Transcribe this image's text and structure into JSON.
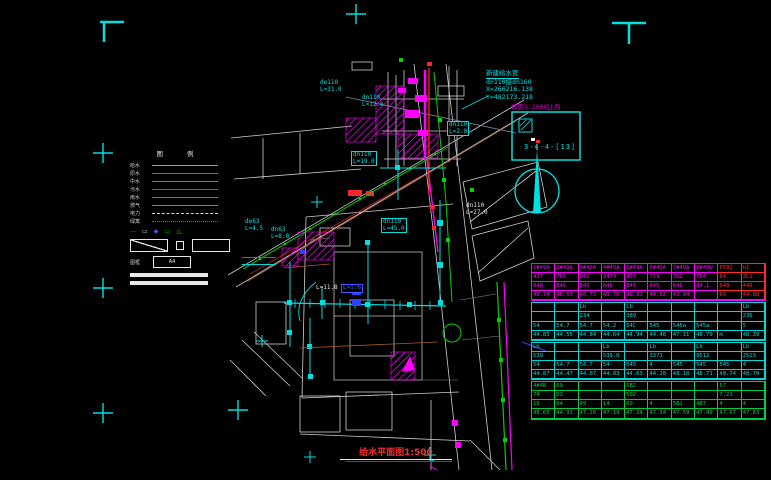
{
  "title": {
    "text": "给水平面图1:500"
  },
  "annotation": {
    "line1": "新建给水管",
    "line2": "dn110接dn160",
    "line3": "X=266216.138",
    "line4": "Y=482173.218"
  },
  "detail_box": {
    "caption": "详图1:2000比例",
    "code": "3-4-4-[13]"
  },
  "colors": {
    "cyan": "#00e0e0",
    "magenta": "#ff00ff",
    "red": "#ff2626",
    "green": "#00d400",
    "blue": "#3040ff",
    "white": "#d8d8d8",
    "table_magenta": "#ff00ff",
    "table_red": "#ff2a2a",
    "table_cyan": "#00d8d8",
    "table_green": "#00cc44"
  },
  "legend": {
    "title": "图 例",
    "rows": [
      {
        "label": "给水",
        "color": "#00dcdc",
        "style": "solid"
      },
      {
        "label": "原水",
        "color": "#ff3434",
        "style": "solid"
      },
      {
        "label": "中水",
        "color": "#00cc00",
        "style": "solid"
      },
      {
        "label": "污水",
        "color": "#a8522a",
        "style": "solid"
      },
      {
        "label": "雨水",
        "color": "#b46432",
        "style": "solid"
      },
      {
        "label": "燃气",
        "color": "#a87838",
        "style": "solid"
      },
      {
        "label": "电力",
        "color": "#d8d8d8",
        "style": "dashed"
      },
      {
        "label": "绿篱",
        "color": "#00bb00",
        "style": "dotted"
      }
    ],
    "symbol_row": [
      {
        "glyph": "—",
        "color": "#4455ff"
      },
      {
        "glyph": "▭",
        "color": "#e8e8e8"
      },
      {
        "glyph": "◆",
        "color": "#4455ff"
      },
      {
        "glyph": "▭",
        "color": "#00bb00"
      },
      {
        "glyph": "么",
        "color": "#00bb00"
      }
    ],
    "paper_label": "图框",
    "paper_box": "A4"
  },
  "labels": [
    {
      "text": "de110\nL=31.0",
      "color": "#00e0e0"
    },
    {
      "text": "dn110\nL=2.0",
      "color": "#00e0e0"
    },
    {
      "text": "dn110\nL=19.0",
      "color": "#00e0e0"
    },
    {
      "text": "dn110\nL=45.0",
      "color": "#00e0e0"
    },
    {
      "text": "dn110\nL=27.0",
      "color": "#e8e8e8"
    },
    {
      "text": "de63\nL=4.5",
      "color": "#00e0e0"
    },
    {
      "text": "dn63\nL=8.0",
      "color": "#00e0e0"
    },
    {
      "text": "L=11.8",
      "color": "#e8e8e8"
    },
    {
      "text": "L=5.6",
      "color": "#4455ff"
    },
    {
      "text": "dn110\nL=12.6",
      "color": "#00e0e0"
    }
  ],
  "table": {
    "sections": [
      {
        "color": "#ff00ff",
        "alt_color": "#ff2a2a",
        "alt_cols": [
          8,
          9
        ],
        "rows": [
          [
            "1#49A",
            "2#49A",
            "3#49A",
            "4#49A",
            "5#49A",
            "6#49A",
            "7#49A",
            "8#49W",
            "P592",
            "b1"
          ],
          [
            "437",
            "765",
            "842",
            "3479",
            "497",
            "759",
            "762",
            "764",
            "84",
            "3L1"
          ],
          [
            "848",
            "846",
            "845",
            "846",
            "848",
            "845",
            "846",
            "84.1",
            "648",
            "449"
          ],
          [
            "48.74",
            "48.63",
            "48.73",
            "48.76",
            "48.81",
            "44.82",
            "43.84",
            "",
            "69",
            "44.88"
          ]
        ]
      },
      {
        "color": "#00d8d8",
        "rows": [
          [
            "",
            "",
            "Lb",
            "",
            "Lb",
            "",
            "",
            "",
            "",
            "Lb"
          ],
          [
            "",
            "",
            "234",
            "",
            "389",
            "",
            "",
            "",
            "",
            "236"
          ],
          [
            "54",
            "54.7",
            "54.7",
            "54.2",
            "54C",
            "545",
            "545a",
            "545a",
            "",
            "5"
          ],
          [
            "44.85",
            "44.55",
            "44.84",
            "44.64",
            "44.94",
            "44.48",
            "47.11",
            "48.79",
            "m",
            "48.39"
          ]
        ]
      },
      {
        "color": "#00d8d8",
        "rows": [
          [
            "Lb",
            "",
            "",
            "Lb",
            "",
            "Lb",
            "",
            "Lb",
            "",
            "Lb"
          ],
          [
            "539",
            "",
            "",
            "539.0",
            "",
            "3371",
            "",
            "8512",
            "",
            "2513"
          ],
          [
            "54",
            "54.7",
            "54.7",
            "54",
            "545",
            "4",
            "545",
            "545",
            "545",
            "4"
          ],
          [
            "44.87",
            "44.47",
            "44.07",
            "44.83",
            "44.63",
            "44.10",
            "48.10",
            "48.71",
            "48.74",
            "48.79"
          ]
        ]
      },
      {
        "color": "#00cc44",
        "rows": [
          [
            "4#4B",
            "69",
            "",
            "",
            "5B2",
            "",
            "",
            "",
            "57",
            ""
          ],
          [
            "74",
            "D3",
            "",
            "",
            "502",
            "",
            "",
            "",
            "7.21",
            ""
          ],
          [
            "19",
            "94",
            "49",
            "14",
            "69",
            "4",
            "5B1",
            "4B7",
            "4",
            "4"
          ],
          [
            "48.65",
            "44.91",
            "47.26",
            "47.19",
            "47.24",
            "47.34",
            "47.59",
            "47.49",
            "47.67",
            "47.63"
          ]
        ]
      }
    ]
  }
}
